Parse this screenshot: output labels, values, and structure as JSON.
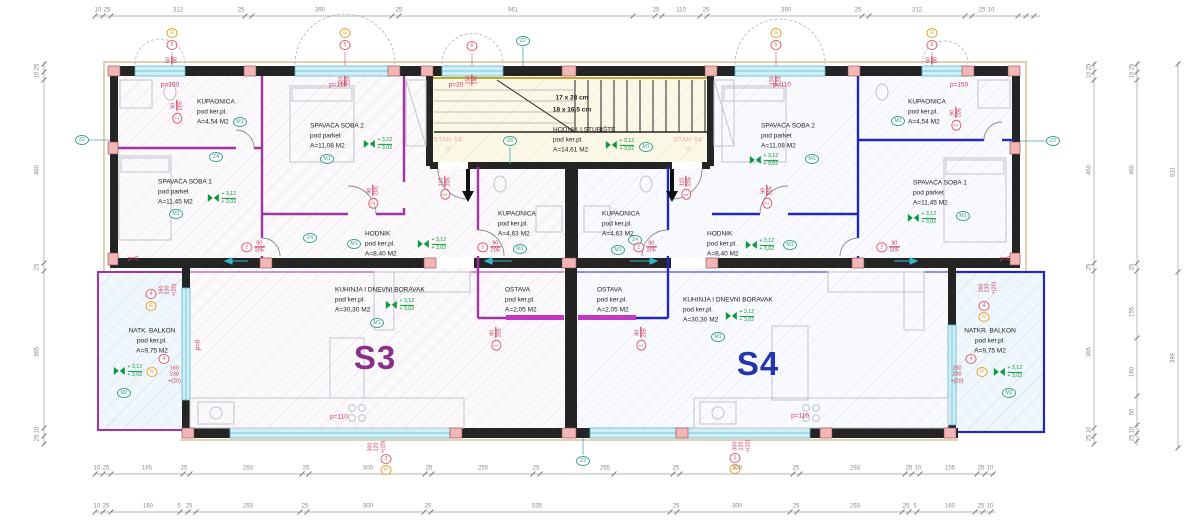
{
  "apartments": {
    "s3": "S3",
    "s4": "S4",
    "stan_s3": "STAN S3",
    "stan_s4": "STAN S4"
  },
  "icons": {
    "stan_pointer": "▽"
  },
  "levels": {
    "upper": "+ 3,12",
    "lower": "+ 3,02"
  },
  "stairs": {
    "dim1": "17 x 28 cm",
    "dim2": "18 x 16,5 cm"
  },
  "marks": {
    "m1": "M1",
    "m2": "M2",
    "z2": "Z2",
    "z4": "Z4",
    "z6": "Z6",
    "g": "G",
    "r": "R"
  },
  "parapets": {
    "p0": "p=0",
    "p20": "p=20",
    "p110": "p=110",
    "p150": "p=150"
  },
  "openings": {
    "d90": {
      "n": "2",
      "w": "90",
      "h": "205"
    },
    "d110": {
      "n": "1",
      "w": "110",
      "h": "205"
    },
    "d80": {
      "n": "1",
      "w": "80",
      "h": "205"
    },
    "w60": {
      "n": "6",
      "w": "60",
      "h": "80"
    },
    "w120": {
      "n": "5",
      "w": "120",
      "h": "120"
    },
    "w150": {
      "n": "8",
      "w": "150",
      "h": "190"
    },
    "w160": {
      "n": "4",
      "w": "160",
      "h": "230",
      "plus": "+(20)"
    },
    "w300": {
      "n": "3",
      "w": "300",
      "h": "120",
      "plus": "+(20)"
    }
  },
  "rooms": [
    {
      "name": "KUPAONICA",
      "floor": "pod ker.pl.",
      "area": "A=4,54 M2"
    },
    {
      "name": "SPAVAĆA SOBA 1",
      "floor": "pod parket",
      "area": "A=11,45 M2"
    },
    {
      "name": "SPAVAĆA SOBA 2",
      "floor": "pod parket",
      "area": "A=11,08 M2"
    },
    {
      "name": "HODNIK",
      "floor": "pod ker.pl.",
      "area": "A=8,40 M2"
    },
    {
      "name": "KUPAONICA",
      "floor": "pod ker.pl.",
      "area": "A=4,63 M2"
    },
    {
      "name": "OSTAVA",
      "floor": "pod ker.pl.",
      "area": "A=2,05 M2"
    },
    {
      "name": "KUHINJA I DNEVNI BORAVAK",
      "floor": "pod ker.pl.",
      "area": "A=30,30 M2"
    },
    {
      "name": "NATK. BALKON",
      "floor": "pod ker.pl.",
      "area": "A=9,75 M2"
    },
    {
      "name": "HODNIK I STUBIŠTE",
      "floor": "pod ker.pl.",
      "area": "A=14,61 M2"
    },
    {
      "name": "KUPAONICA",
      "floor": "pod ker.pl.",
      "area": "A=4,63 M2"
    },
    {
      "name": "OSTAVA",
      "floor": "pod ker.pl.",
      "area": "A=2,05 M2"
    },
    {
      "name": "SPAVAĆA SOBA 2",
      "floor": "pod parket",
      "area": "A=11,08 M2"
    },
    {
      "name": "KUPAONICA",
      "floor": "pod ker.pl.",
      "area": "A=4,54 M2"
    },
    {
      "name": "SPAVAĆA SOBA 1",
      "floor": "pod parket",
      "area": "A=11,45 M2"
    },
    {
      "name": "HODNIK",
      "floor": "pod ker.pl.",
      "area": "A=8,40 M2"
    },
    {
      "name": "KUHINJA I DNEVNI BORAVAK",
      "floor": "pod ker.pl.",
      "area": "A=30,30 M2"
    },
    {
      "name": "NATKR. BALKON",
      "floor": "pod ker.pl.",
      "area": "A=9,75 M2"
    }
  ],
  "dims": {
    "top": [
      "10",
      "25",
      "312",
      "25",
      "390",
      "25",
      "561",
      "25",
      "110",
      "25",
      "390",
      "25",
      "312",
      "25",
      "10"
    ],
    "bottom1": [
      "10",
      "25",
      "165",
      "25",
      "293",
      "25",
      "300",
      "25",
      "255",
      "25",
      "255",
      "25",
      "300",
      "25",
      "293",
      "25",
      "10",
      "155",
      "25",
      "10"
    ],
    "bottom2": [
      "10",
      "25",
      "160",
      "5",
      "25",
      "293",
      "25",
      "300",
      "25",
      "535",
      "25",
      "300",
      "25",
      "293",
      "25",
      "5",
      "160",
      "25",
      "10"
    ],
    "right1": [
      "25",
      "10",
      "460",
      "25",
      "365",
      "10",
      "25"
    ],
    "right2": [
      "25",
      "10",
      "460",
      "25",
      "155",
      "160",
      "50",
      "10",
      "25"
    ],
    "right3": [
      "531",
      "389"
    ],
    "left": [
      "25",
      "10",
      "460",
      "25",
      "365",
      "10",
      "25"
    ]
  },
  "colors": {
    "s3_accent": "#a233a2",
    "s4_accent": "#2626b8",
    "stairs_accent": "#c2a92f",
    "window": "#cfeef6",
    "label_red": "#cd3252",
    "label_green": "#0a9a3c"
  }
}
